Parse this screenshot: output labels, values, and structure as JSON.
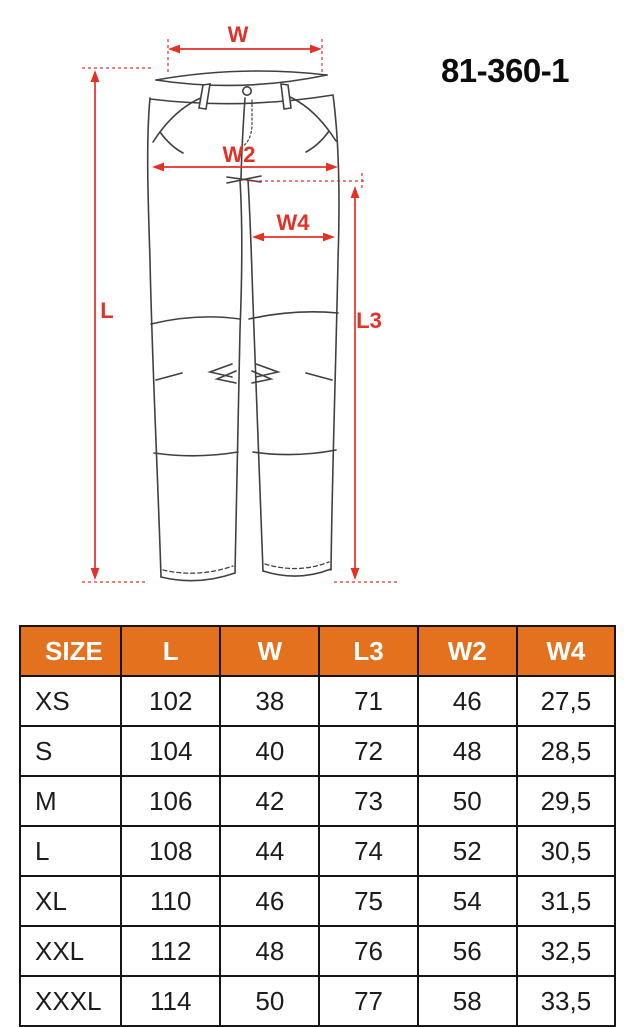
{
  "product": {
    "model": "81-360-1"
  },
  "diagram": {
    "description": "front-view technical line drawing of work trousers with measurement arrows",
    "labels": {
      "w": "W",
      "w2": "W2",
      "w4": "W4",
      "l": "L",
      "l3": "L3"
    },
    "accent_color": "#e43127",
    "line_color": "#404040"
  },
  "table": {
    "header_bg": "#e4711d",
    "header": [
      "SIZE",
      "L",
      "W",
      "L3",
      "W2",
      "W4"
    ],
    "rows": [
      [
        "XS",
        "102",
        "38",
        "71",
        "46",
        "27,5"
      ],
      [
        "S",
        "104",
        "40",
        "72",
        "48",
        "28,5"
      ],
      [
        "M",
        "106",
        "42",
        "73",
        "50",
        "29,5"
      ],
      [
        "L",
        "108",
        "44",
        "74",
        "52",
        "30,5"
      ],
      [
        "XL",
        "110",
        "46",
        "75",
        "54",
        "31,5"
      ],
      [
        "XXL",
        "112",
        "48",
        "76",
        "56",
        "32,5"
      ],
      [
        "XXXL",
        "114",
        "50",
        "77",
        "58",
        "33,5"
      ]
    ]
  }
}
